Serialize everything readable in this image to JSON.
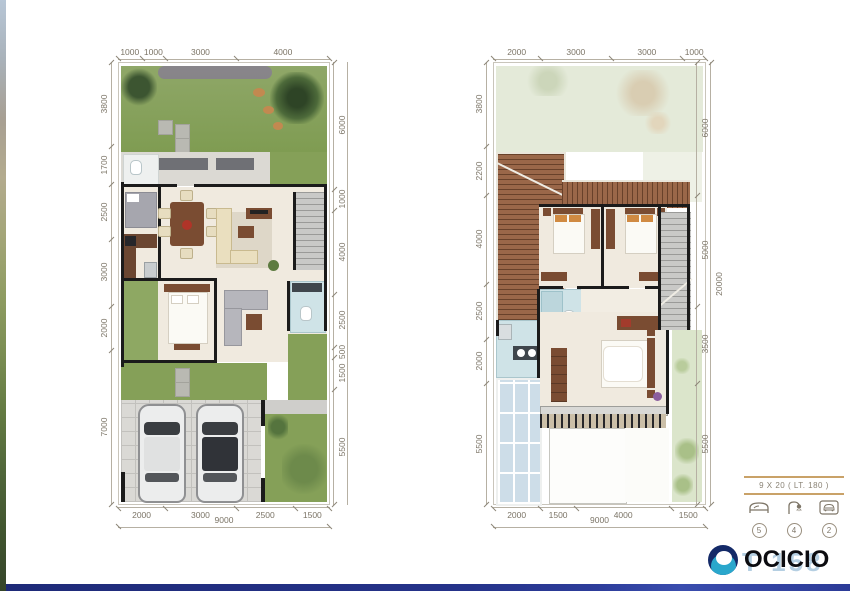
{
  "sheet": {
    "background": "#ffffff"
  },
  "plans": {
    "left": {
      "dims_top": [
        1000,
        1000,
        3000,
        4000
      ],
      "dims_left": [
        3800,
        1700,
        2500,
        3000,
        2000,
        7000
      ],
      "dims_right": [
        6000,
        1000,
        4000,
        2500,
        500,
        1500,
        5500
      ],
      "dims_bottom": [
        2000,
        3000,
        2500,
        1500
      ],
      "dims_bottom_total": [
        9000
      ]
    },
    "right": {
      "dims_top": [
        2000,
        3000,
        3000,
        1000
      ],
      "dims_left": [
        3800,
        2200,
        4000,
        2500,
        2000,
        5500
      ],
      "dims_right": [
        6000,
        5000,
        3500,
        5500
      ],
      "dims_right_total": [
        20000
      ],
      "dims_bottom": [
        2000,
        1500,
        4000,
        1500
      ],
      "dims_bottom_total": [
        9000
      ]
    }
  },
  "info": {
    "size_label": "9 X 20  ( LT. 180 )",
    "features": [
      {
        "icon": "bed-icon",
        "count": "5"
      },
      {
        "icon": "shower-icon",
        "count": "4"
      },
      {
        "icon": "car-icon",
        "count": "2"
      }
    ]
  },
  "branding": {
    "logo_text": "OCICIO",
    "watermark_text": "T 158"
  },
  "colors": {
    "dim_text": "#7b7466",
    "dim_line": "#b6b0a3",
    "accent_rule": "#c9a268",
    "grass": "#85a058",
    "roof": "#9a6749",
    "bath": "#cfe3e7",
    "wood": "#7a4c32",
    "logo_navy": "#142a68",
    "logo_teal": "#2aa7cc",
    "watermark_blue": "#b5cfe2",
    "bottom_bar": "#25338a"
  }
}
